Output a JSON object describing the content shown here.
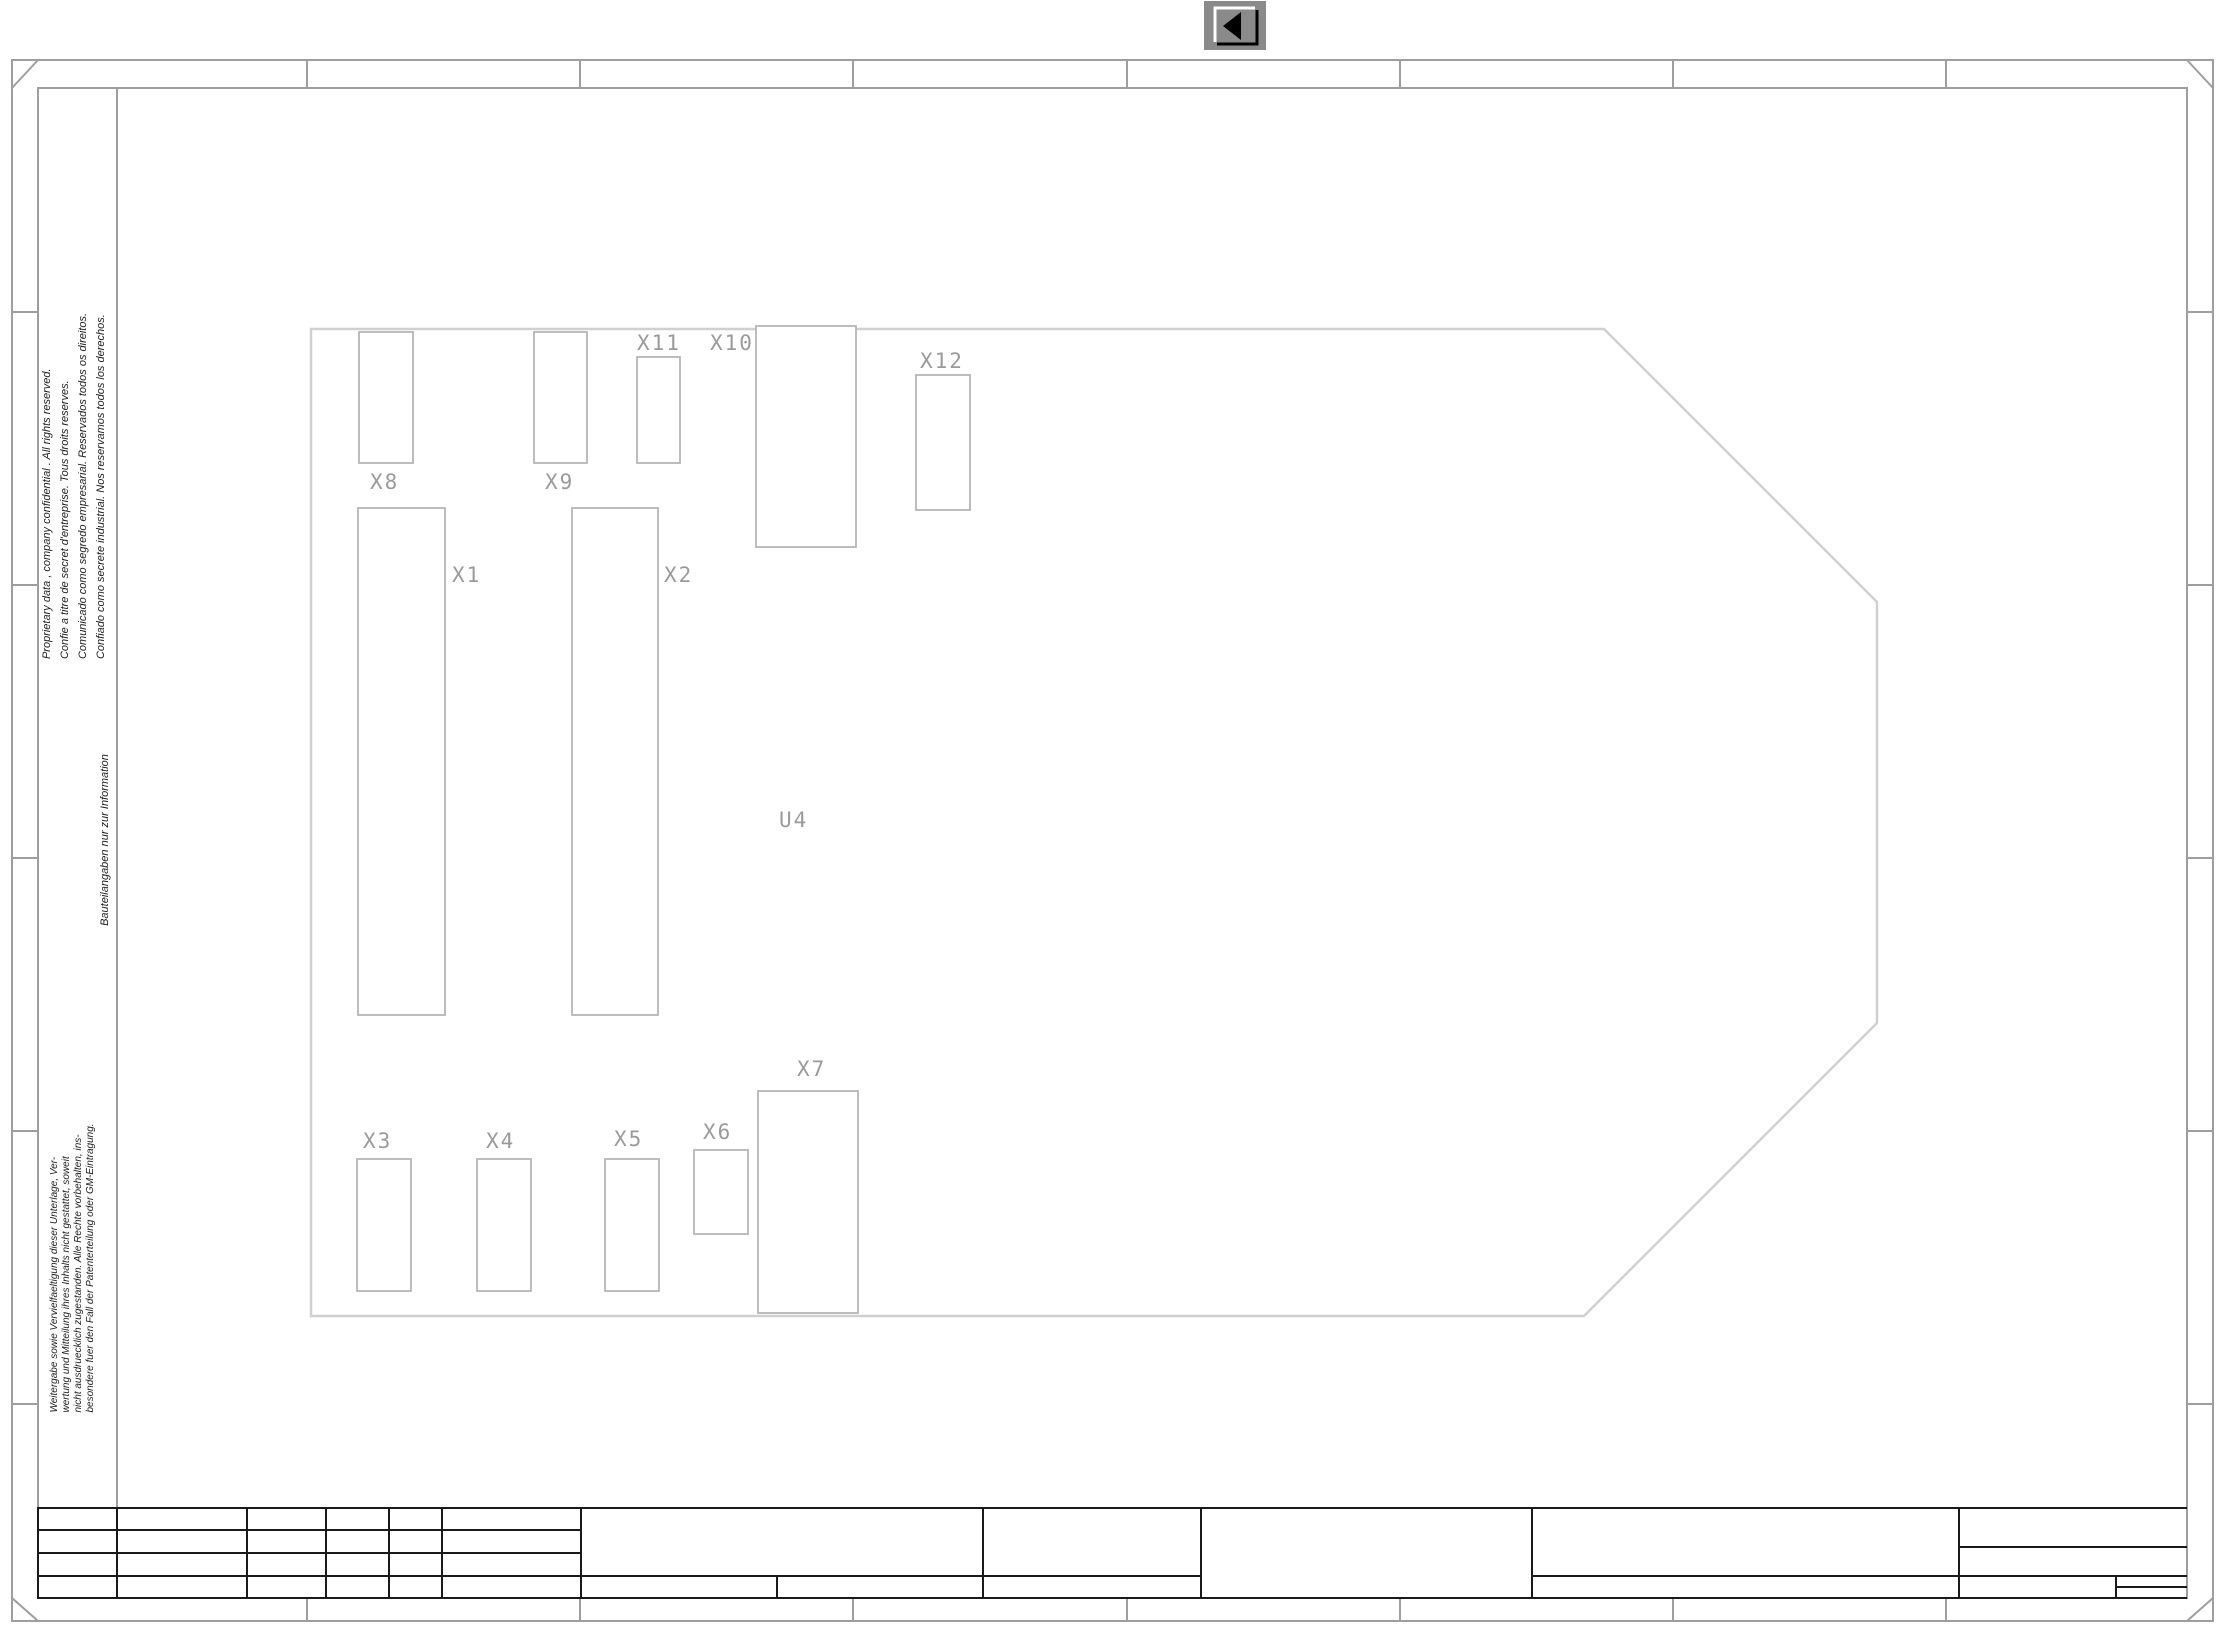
{
  "toolbar": {
    "icons": {
      "back": "◀ left-pointing triangle"
    }
  },
  "components": {
    "x1": "X1",
    "x2": "X2",
    "x3": "X3",
    "x4": "X4",
    "x5": "X5",
    "x6": "X6",
    "x7": "X7",
    "x8": "X8",
    "x9": "X9",
    "x10": "X10",
    "x11": "X11",
    "x12": "X12",
    "u4": "U4"
  },
  "margin_notes": {
    "proprietary": {
      "lines": [
        "Proprietary data , company confidential .  All rights reserved.",
        "Confie a titre de secret d'entreprise. Tous droits reserves.",
        "Comunicado como segredo empresarial. Reservados todos os direitos.",
        "Confiado como secrete industrial. Nos reservamos todos los derechos."
      ]
    },
    "info_note": "Bauteilangaben nur zur Information",
    "german_note": {
      "lines": [
        "Weitergabe sowie Vervielfaeltigung dieser Unterlage,  Ver-",
        "wertung und Mitteilung ihres Inhalts nicht gestattet, soweit",
        "nicht ausdruecklich zugestanden. Alle Rechte vorbehalten, ins-",
        "besondere fuer den Fall der Patenterteilung oder GM-Eintragung."
      ]
    }
  },
  "colors": {
    "frame_line": "#9e9e9e",
    "board_outline": "#d0d0d0",
    "component_outline": "#b6b6b6",
    "title_block_line": "#1a1a1a",
    "label_text": "#9a9a9a",
    "note_text": "#1c1c1c",
    "button_gray": "#8a8a8a"
  }
}
